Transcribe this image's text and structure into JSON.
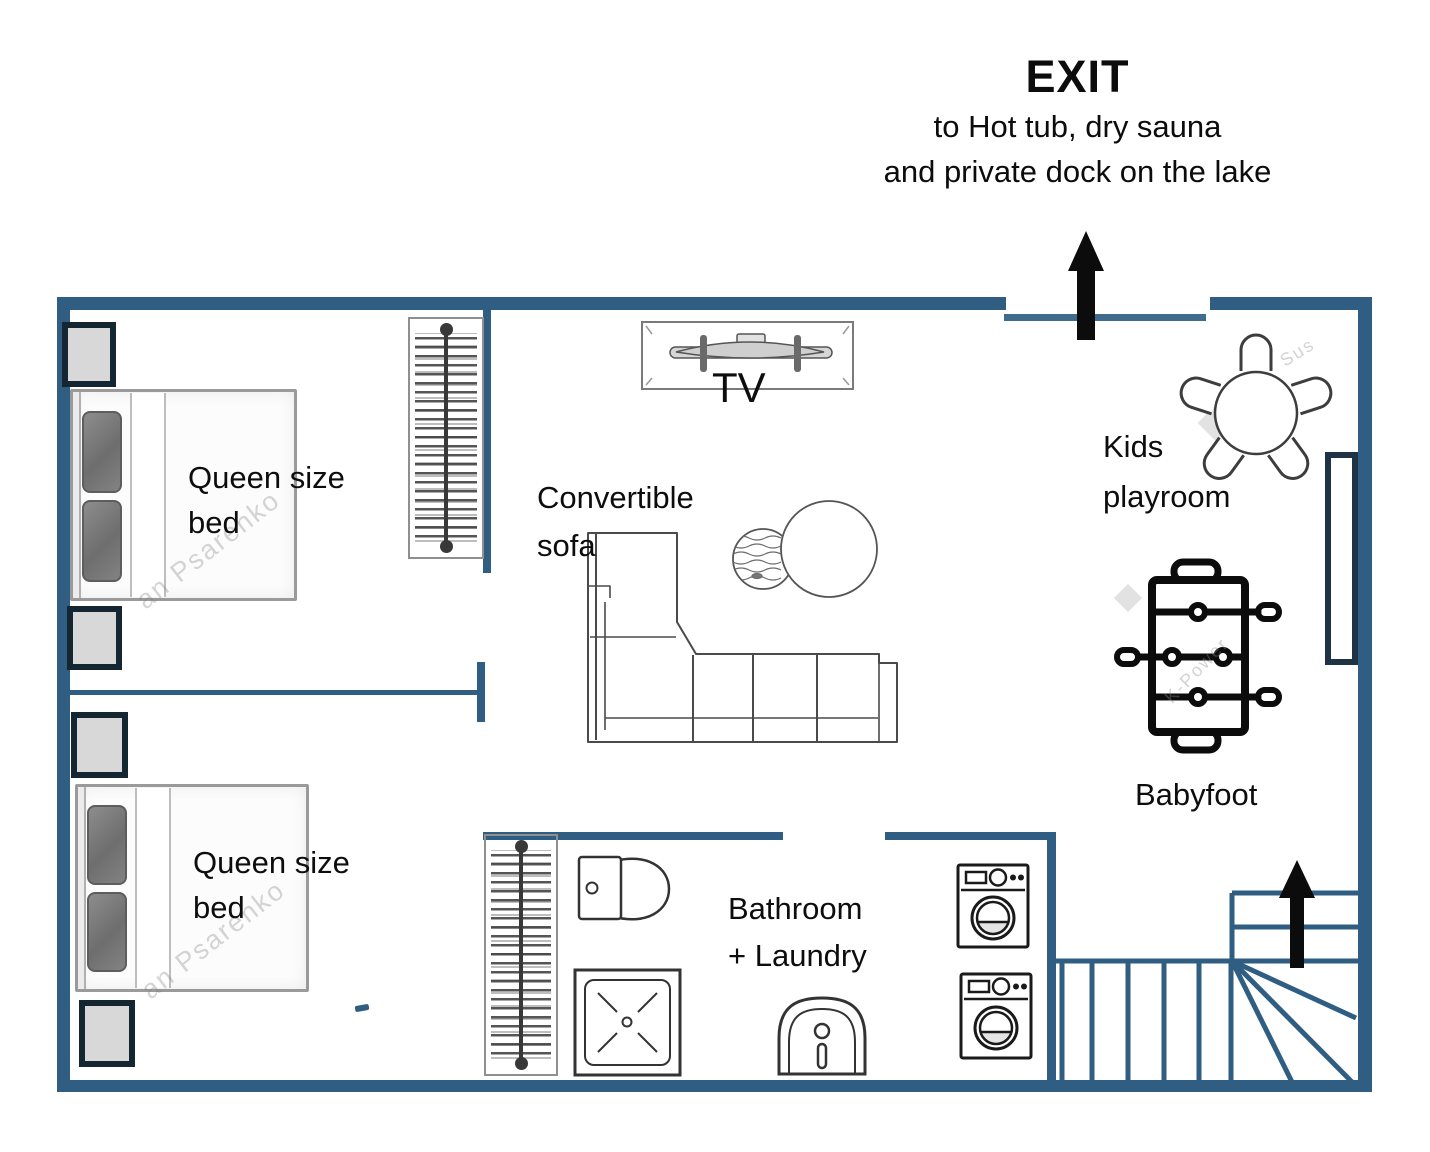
{
  "exit_sign": {
    "title": "EXIT",
    "subtitle_line1": "to Hot tub, dry sauna",
    "subtitle_line2": "and private dock on the lake"
  },
  "labels": {
    "tv": "TV",
    "sofa_line1": "Convertible",
    "sofa_line2": "sofa",
    "bedroom_top_line1": "Queen size",
    "bedroom_top_line2": "bed",
    "bedroom_bottom_line1": "Queen size",
    "bedroom_bottom_line2": "bed",
    "kids_line1": "Kids",
    "kids_line2": "playroom",
    "babyfoot": "Babyfoot",
    "bathroom_line1": "Bathroom",
    "bathroom_line2": "+ Laundry"
  },
  "watermarks": {
    "bed_top": "an Psarenko",
    "bed_bottom": "an Psarenko",
    "kids_area": "Sus",
    "babyfoot_area": "K-Power"
  },
  "colors": {
    "wall": "#2F5E82",
    "dark_navy": "#152633",
    "black": "#0C0C0C",
    "furniture_line": "#4A4A4A",
    "nightstand_fill": "#D8D8D8"
  }
}
